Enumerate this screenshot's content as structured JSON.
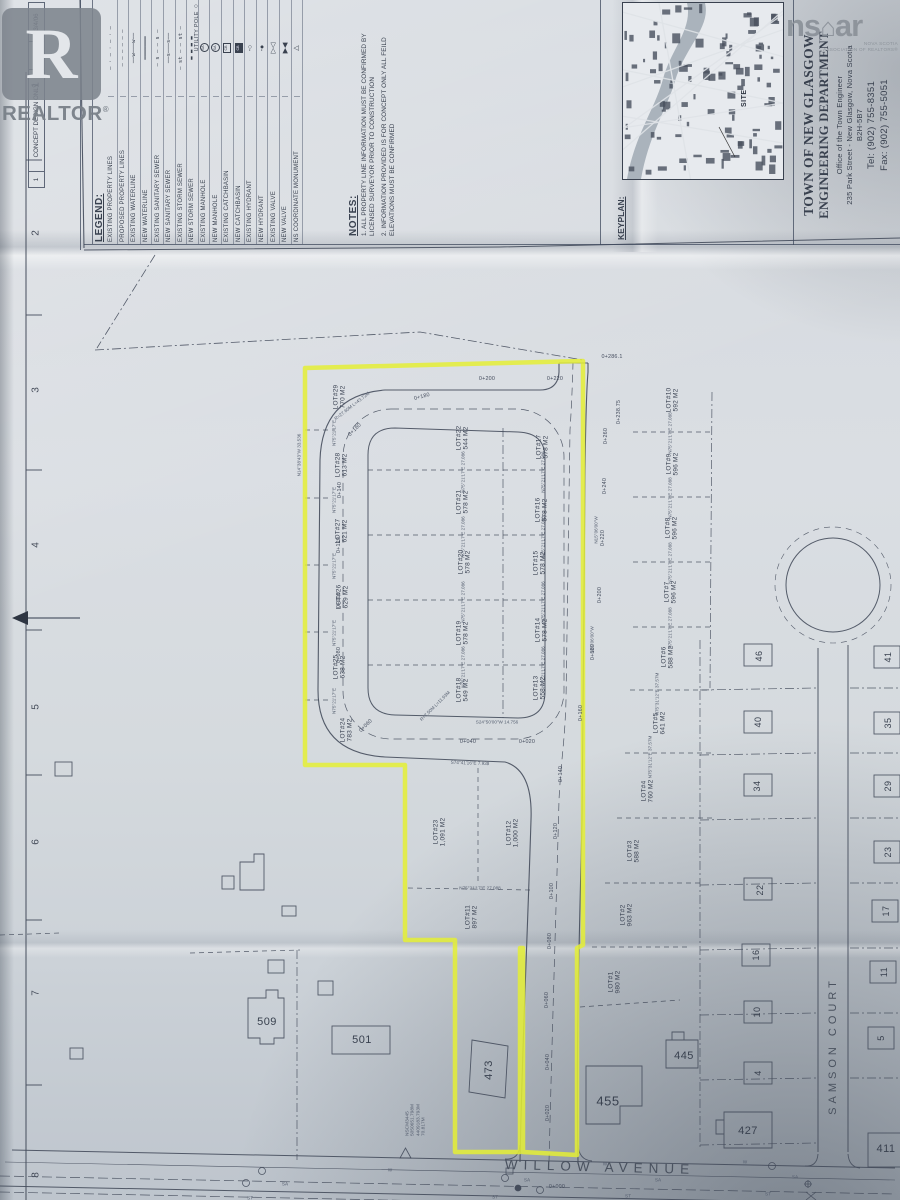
{
  "watermarks": {
    "realtor": {
      "big_letter": "R",
      "label": "REALTOR",
      "reg": "®"
    },
    "nsar": {
      "part1": "ns",
      "house_icon": "⌂",
      "part2": "ar",
      "sub1": "NOVA SCOTIA",
      "sub2": "ASSOCIATION OF REALTORS®"
    }
  },
  "sheet": {
    "grid_numbers": [
      "1",
      "2",
      "3",
      "4",
      "5",
      "6",
      "7",
      "8"
    ],
    "revision": {
      "no": "1",
      "desc": "CONCEPT DESIGN ONLY",
      "by": "RPS",
      "date": "3/4/06"
    },
    "legend": {
      "title": "LEGEND:",
      "items": [
        {
          "label": "EXISTING PROPERTY LINES",
          "sym": "dashdot"
        },
        {
          "label": "PROPOSED PROPERTY LINES",
          "sym": "dash"
        },
        {
          "label": "EXISTING WATERLINE",
          "sym": "wline"
        },
        {
          "label": "NEW WATERLINE",
          "sym": "solid"
        },
        {
          "label": "EXISTING SANITARY SEWER",
          "sym": "sa_d"
        },
        {
          "label": "NEW SANITARY SEWER",
          "sym": "sa_s"
        },
        {
          "label": "EXISTING STORM SEWER",
          "sym": "st_d"
        },
        {
          "label": "NEW STORM SEWER",
          "sym": "st_h"
        },
        {
          "label": "EXISTING MANHOLE",
          "sym": "mh_e",
          "glyph_text": "SA"
        },
        {
          "label": "NEW MANHOLE",
          "sym": "mh_n",
          "glyph_text": "SA"
        },
        {
          "label": "EXISTING CATCHBASIN",
          "sym": "cb_e",
          "glyph_text": "CB"
        },
        {
          "label": "NEW CATCHBASIN",
          "sym": "cb_n",
          "glyph_text": "CB"
        },
        {
          "label": "EXISTING HYDRANT",
          "sym": "hyd_e"
        },
        {
          "label": "NEW HYDRANT",
          "sym": "hyd_n"
        },
        {
          "label": "EXISTING VALVE",
          "sym": "valve_e"
        },
        {
          "label": "NEW VALVE",
          "sym": "valve_n"
        },
        {
          "label": "NS COORDINATE MONUMENT",
          "sym": "mon"
        }
      ],
      "extra": {
        "label": "UTILITY POLE",
        "sym": "pole"
      }
    },
    "notes": {
      "title": "NOTES:",
      "items": [
        "1. ALL PROPERTY LINE INFORMATION MUST BE CONFIRMED BY LICENSED SURVEYOR PRIOR TO CONSTRUCTION",
        "2. INFORMATION PROVIDED IS FOR CONCEPT ONLY ALL FEILD ELEVATIONS MUST BE CONFIRMED"
      ]
    },
    "keyplan": {
      "title": "KEYPLAN:",
      "site_label": "SITE"
    },
    "title_block": {
      "line1": "TOWN OF NEW GLASGOW",
      "line2": "ENGINEERING DEPARTMENT",
      "line3": "Office of the Town Engineer",
      "line4": "235 Park Street - New Glasgow, Nova Scotia",
      "line5": "B2H-5B7",
      "line6": "Tel: (902) 755-8351",
      "line7": "Fax: (902) 755-5051"
    }
  },
  "plan": {
    "streets": {
      "willow": "WILLOW AVENUE",
      "samson": "SAMSON COURT"
    },
    "lots": [
      {
        "id": "LOT#1",
        "area": "980 M2",
        "x": 615,
        "y": 982
      },
      {
        "id": "LOT#2",
        "area": "963 M2",
        "x": 627,
        "y": 915
      },
      {
        "id": "LOT#3",
        "area": "588 M2",
        "x": 634,
        "y": 851
      },
      {
        "id": "LOT#4",
        "area": "760 M2",
        "x": 648,
        "y": 791
      },
      {
        "id": "LOT#5",
        "area": "641 M2",
        "x": 660,
        "y": 723
      },
      {
        "id": "LOT#6",
        "area": "588 M2",
        "x": 668,
        "y": 657
      },
      {
        "id": "LOT#7",
        "area": "596 M2",
        "x": 671,
        "y": 592
      },
      {
        "id": "LOT#8",
        "area": "596 M2",
        "x": 672,
        "y": 528
      },
      {
        "id": "LOT#9",
        "area": "596 M2",
        "x": 673,
        "y": 464
      },
      {
        "id": "LOT#10",
        "area": "592 M2",
        "x": 673,
        "y": 400
      },
      {
        "id": "LOT#11",
        "area": "897 M2",
        "x": 472,
        "y": 917
      },
      {
        "id": "LOT#12",
        "area": "1,000 M2",
        "x": 513,
        "y": 833
      },
      {
        "id": "LOT#13",
        "area": "558 M2",
        "x": 540,
        "y": 688
      },
      {
        "id": "LOT#14",
        "area": "578 M2",
        "x": 542,
        "y": 630
      },
      {
        "id": "LOT#15",
        "area": "578 M2",
        "x": 540,
        "y": 563
      },
      {
        "id": "LOT#16",
        "area": "578 M2",
        "x": 542,
        "y": 510
      },
      {
        "id": "LOT#17",
        "area": "578 M2",
        "x": 543,
        "y": 447
      },
      {
        "id": "LOT#18",
        "area": "549 M2",
        "x": 463,
        "y": 690
      },
      {
        "id": "LOT#19",
        "area": "578 M2",
        "x": 463,
        "y": 633
      },
      {
        "id": "LOT#20",
        "area": "578 M2",
        "x": 465,
        "y": 562
      },
      {
        "id": "LOT#21",
        "area": "578 M2",
        "x": 463,
        "y": 502
      },
      {
        "id": "LOT#22",
        "area": "544 M2",
        "x": 463,
        "y": 438
      },
      {
        "id": "LOT#23",
        "area": "1,091 M2",
        "x": 440,
        "y": 832
      },
      {
        "id": "LOT#24",
        "area": "783 M2",
        "x": 347,
        "y": 730
      },
      {
        "id": "LOT#25",
        "area": "638 M2",
        "x": 340,
        "y": 667
      },
      {
        "id": "LOT#26",
        "area": "629 M2",
        "x": 343,
        "y": 597
      },
      {
        "id": "LOT#27",
        "area": "621 M2",
        "x": 342,
        "y": 531
      },
      {
        "id": "LOT#28",
        "area": "613 M2",
        "x": 342,
        "y": 465
      },
      {
        "id": "LOT#29",
        "area": "770 M2",
        "x": 340,
        "y": 397
      }
    ],
    "houses": [
      {
        "n": "509",
        "x": 267,
        "y": 1022,
        "s": 11
      },
      {
        "n": "501",
        "x": 362,
        "y": 1040,
        "s": 11
      },
      {
        "n": "473",
        "x": 489,
        "y": 1070,
        "s": 11,
        "r": -90
      },
      {
        "n": "455",
        "x": 608,
        "y": 1102,
        "s": 13
      },
      {
        "n": "445",
        "x": 684,
        "y": 1056,
        "s": 11
      },
      {
        "n": "427",
        "x": 748,
        "y": 1131,
        "s": 11
      },
      {
        "n": "411",
        "x": 886,
        "y": 1149,
        "s": 11
      },
      {
        "n": "46",
        "x": 759,
        "y": 656,
        "s": 9,
        "r": -90
      },
      {
        "n": "40",
        "x": 758,
        "y": 722,
        "s": 9,
        "r": -90
      },
      {
        "n": "34",
        "x": 757,
        "y": 786,
        "s": 9,
        "r": -90
      },
      {
        "n": "22",
        "x": 760,
        "y": 890,
        "s": 9,
        "r": -90
      },
      {
        "n": "16",
        "x": 756,
        "y": 955,
        "s": 9,
        "r": -90
      },
      {
        "n": "10",
        "x": 757,
        "y": 1012,
        "s": 9,
        "r": -90
      },
      {
        "n": "4",
        "x": 758,
        "y": 1073,
        "s": 9,
        "r": -90
      },
      {
        "n": "41",
        "x": 888,
        "y": 657,
        "s": 9,
        "r": -90
      },
      {
        "n": "35",
        "x": 888,
        "y": 723,
        "s": 9,
        "r": -90
      },
      {
        "n": "29",
        "x": 888,
        "y": 786,
        "s": 9,
        "r": -90
      },
      {
        "n": "23",
        "x": 888,
        "y": 852,
        "s": 9,
        "r": -90
      },
      {
        "n": "17",
        "x": 886,
        "y": 911,
        "s": 9,
        "r": -90
      },
      {
        "n": "11",
        "x": 884,
        "y": 972,
        "s": 9,
        "r": -90
      },
      {
        "n": "5",
        "x": 881,
        "y": 1038,
        "s": 9,
        "r": -90
      }
    ],
    "stations": [
      {
        "t": "0+000",
        "x": 557,
        "y": 1187,
        "r": 0
      },
      {
        "t": "0+020",
        "x": 548,
        "y": 1113
      },
      {
        "t": "0+040",
        "x": 548,
        "y": 1062
      },
      {
        "t": "0+060",
        "x": 547,
        "y": 1000
      },
      {
        "t": "0+080",
        "x": 550,
        "y": 941
      },
      {
        "t": "0+100",
        "x": 552,
        "y": 891
      },
      {
        "t": "0+120",
        "x": 556,
        "y": 831
      },
      {
        "t": "0+140",
        "x": 561,
        "y": 774
      },
      {
        "t": "0+160",
        "x": 581,
        "y": 713
      },
      {
        "t": "0+180",
        "x": 593,
        "y": 652
      },
      {
        "t": "0+200",
        "x": 600,
        "y": 595
      },
      {
        "t": "0+220",
        "x": 603,
        "y": 538
      },
      {
        "t": "0+240",
        "x": 605,
        "y": 486
      },
      {
        "t": "0+260",
        "x": 606,
        "y": 436
      },
      {
        "t": "0+238.75",
        "x": 619,
        "y": 412
      },
      {
        "t": "0+286.1",
        "x": 612,
        "y": 357,
        "r": 0
      },
      {
        "t": "0+020",
        "x": 527,
        "y": 742,
        "r": 0
      },
      {
        "t": "0+040",
        "x": 468,
        "y": 742,
        "r": 0
      },
      {
        "t": "0+060",
        "x": 366,
        "y": 726,
        "r": -45
      },
      {
        "t": "0+080",
        "x": 339,
        "y": 655
      },
      {
        "t": "0+100",
        "x": 339,
        "y": 600
      },
      {
        "t": "0+120",
        "x": 339,
        "y": 545
      },
      {
        "t": "0+140",
        "x": 340,
        "y": 490
      },
      {
        "t": "0+160",
        "x": 355,
        "y": 430,
        "r": -45
      },
      {
        "t": "0+180",
        "x": 422,
        "y": 397,
        "r": -15
      },
      {
        "t": "0+200",
        "x": 487,
        "y": 379,
        "r": 0
      },
      {
        "t": "0+220",
        "x": 555,
        "y": 379,
        "r": 0
      }
    ],
    "micro": [
      {
        "t": "N75°21'17\"E 27.086",
        "x": 463,
        "y": 472
      },
      {
        "t": "N75°21'17\"E 27.086",
        "x": 543,
        "y": 472
      },
      {
        "t": "N75°21'17\"E 27.086",
        "x": 463,
        "y": 537
      },
      {
        "t": "N75°21'17\"E 27.086",
        "x": 543,
        "y": 537
      },
      {
        "t": "N75°21'17\"E 27.086",
        "x": 463,
        "y": 602
      },
      {
        "t": "N75°21'17\"E 27.086",
        "x": 543,
        "y": 602
      },
      {
        "t": "N75°21'17\"E 27.086",
        "x": 463,
        "y": 667
      },
      {
        "t": "N75°21'17\"E 27.086",
        "x": 543,
        "y": 667
      },
      {
        "t": "N75°21'17\"E",
        "x": 334,
        "y": 433
      },
      {
        "t": "N75°21'17\"E",
        "x": 334,
        "y": 500
      },
      {
        "t": "N75°21'17\"E",
        "x": 334,
        "y": 566
      },
      {
        "t": "N75°21'17\"E",
        "x": 334,
        "y": 633
      },
      {
        "t": "N75°21'17\"E",
        "x": 334,
        "y": 701
      },
      {
        "t": "N75°21'17\"E 27.088",
        "x": 670,
        "y": 433
      },
      {
        "t": "N75°21'17\"E 27.088",
        "x": 670,
        "y": 498
      },
      {
        "t": "N75°21'17\"E 27.088",
        "x": 670,
        "y": 563
      },
      {
        "t": "N75°21'17\"E 27.088",
        "x": 670,
        "y": 628
      },
      {
        "t": "N75°31'12\"E 37.57M",
        "x": 657,
        "y": 694
      },
      {
        "t": "N75°31'12\"E 37.57M",
        "x": 650,
        "y": 757
      },
      {
        "t": "N15°06'00\"W",
        "x": 596,
        "y": 530
      },
      {
        "t": "N15°06'00\"W",
        "x": 592,
        "y": 640
      },
      {
        "t": "N14°38'43\"W 33.536",
        "x": 299,
        "y": 455
      },
      {
        "t": "R=27.60M L=43.72M",
        "x": 352,
        "y": 406,
        "r": -38
      },
      {
        "t": "R=7.50M L=11.93M",
        "x": 435,
        "y": 706,
        "r": -45
      },
      {
        "t": "S74°41'16\"E 7.938",
        "x": 470,
        "y": 763,
        "r": 2
      },
      {
        "t": "S24°50'00\"W 14.756",
        "x": 497,
        "y": 722,
        "r": 0
      },
      {
        "t": "N75°21'17\"E 27.088",
        "x": 480,
        "y": 888,
        "r": 0
      },
      {
        "t": "SA",
        "x": 285,
        "y": 1184,
        "r": 2
      },
      {
        "t": "SA",
        "x": 527,
        "y": 1180,
        "r": 2
      },
      {
        "t": "SA",
        "x": 658,
        "y": 1180,
        "r": 2
      },
      {
        "t": "SA",
        "x": 795,
        "y": 1177,
        "r": 2
      },
      {
        "t": "ST",
        "x": 250,
        "y": 1198,
        "r": 2
      },
      {
        "t": "ST",
        "x": 495,
        "y": 1197,
        "r": 2
      },
      {
        "t": "ST",
        "x": 628,
        "y": 1196,
        "r": 2
      },
      {
        "t": "ST",
        "x": 768,
        "y": 1194,
        "r": 2
      },
      {
        "t": "W",
        "x": 390,
        "y": 1170,
        "r": 2
      },
      {
        "t": "W",
        "x": 605,
        "y": 1164,
        "r": 2
      },
      {
        "t": "W",
        "x": 745,
        "y": 1162,
        "r": 2
      }
    ],
    "monument": {
      "lines": [
        "NSCM3445",
        "5050651.798M",
        "4409183.793M",
        "70.817M"
      ],
      "x": 416,
      "y": 1120
    },
    "highlight_color": "#e4ee35"
  }
}
